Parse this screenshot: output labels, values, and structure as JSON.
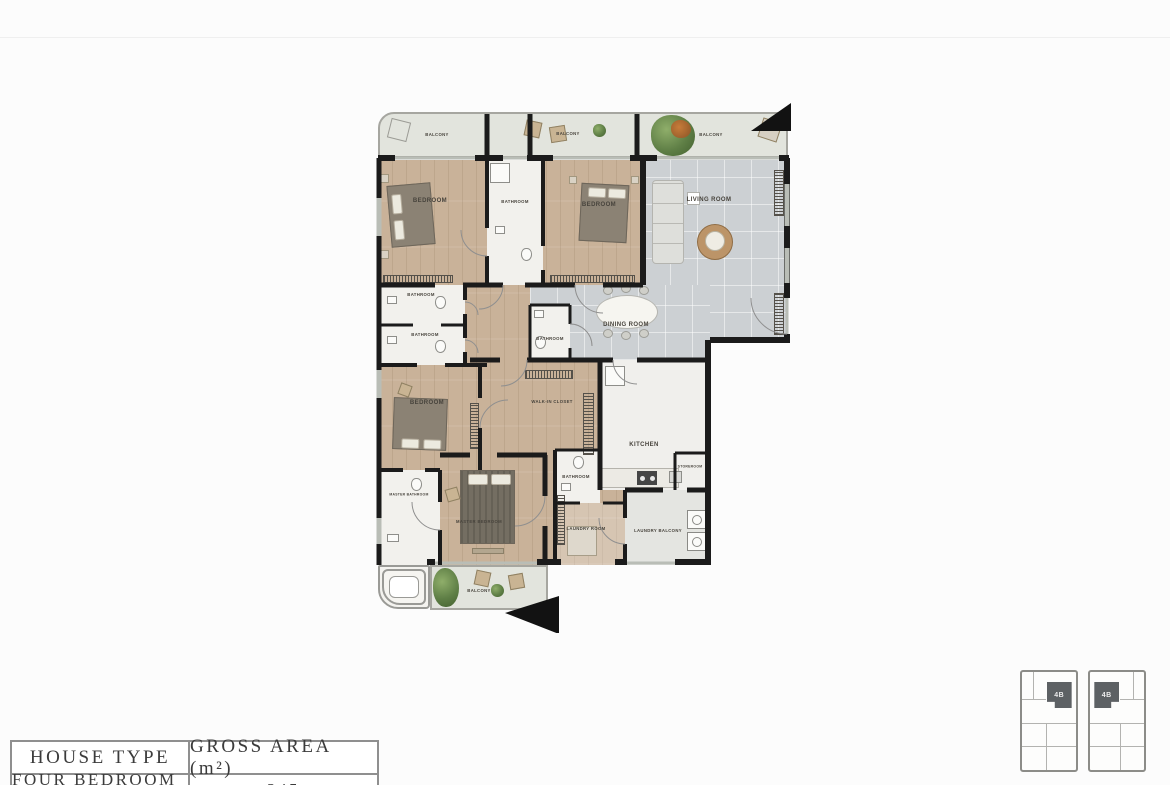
{
  "plan": {
    "rooms": [
      {
        "id": "balcony-top-left",
        "label": "BALCONY"
      },
      {
        "id": "balcony-top-middle",
        "label": "BALCONY"
      },
      {
        "id": "balcony-top-right",
        "label": "BALCONY"
      },
      {
        "id": "bedroom-1",
        "label": "BEDROOM"
      },
      {
        "id": "bathroom-1",
        "label": "BATHROOM"
      },
      {
        "id": "bedroom-2",
        "label": "BEDROOM"
      },
      {
        "id": "living-room",
        "label": "LIVING ROOM"
      },
      {
        "id": "bathroom-2",
        "label": "BATHROOM"
      },
      {
        "id": "bathroom-3",
        "label": "BATHROOM"
      },
      {
        "id": "bathroom-4",
        "label": "BATHROOM"
      },
      {
        "id": "dining-room",
        "label": "DINING ROOM"
      },
      {
        "id": "bedroom-3",
        "label": "BEDROOM"
      },
      {
        "id": "walk-in-closet",
        "label": "WALK-IN CLOSET"
      },
      {
        "id": "kitchen",
        "label": "KITCHEN"
      },
      {
        "id": "storeroom",
        "label": "STOREROOM"
      },
      {
        "id": "bathroom-5",
        "label": "BATHROOM"
      },
      {
        "id": "master-bathroom",
        "label": "MASTER BATHROOM"
      },
      {
        "id": "master-bedroom",
        "label": "MASTER BEDROOM"
      },
      {
        "id": "laundry-room",
        "label": "LAUNDRY ROOM"
      },
      {
        "id": "laundry-balcony",
        "label": "LAUNDRY BALCONY"
      },
      {
        "id": "balcony-bottom",
        "label": "BALCONY"
      }
    ],
    "colors": {
      "wood_floor": "#c9b299",
      "tile_floor": "#ccd0d3",
      "balcony_floor": "#e2e4dd",
      "wall": "#1b1b1b"
    }
  },
  "table": {
    "headers": [
      "HOUSE TYPE",
      "GROSS AREA (m²)"
    ],
    "rows": [
      {
        "house_type": "FOUR BEDROOM B",
        "gross_area": "245"
      }
    ]
  },
  "keyplan": {
    "units": [
      {
        "label": "4B"
      },
      {
        "label": "4B"
      }
    ],
    "highlight_color": "#5d6164"
  }
}
